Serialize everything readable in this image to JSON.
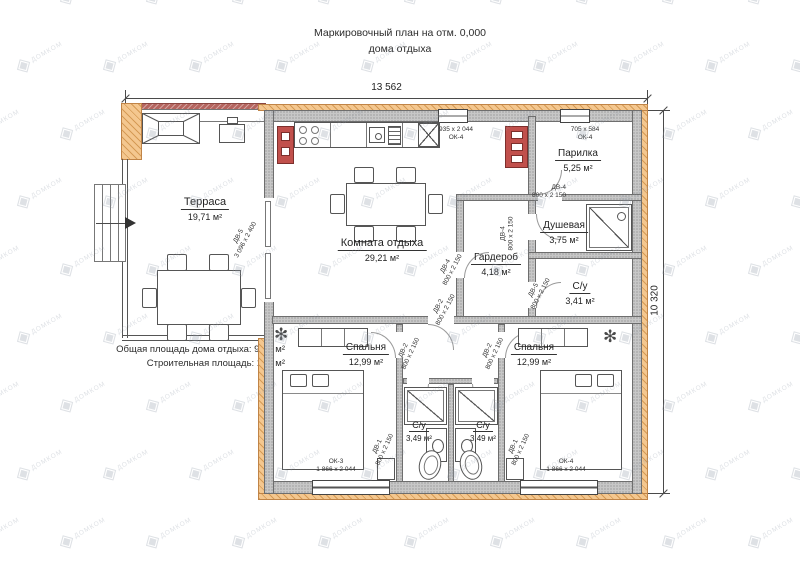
{
  "title": {
    "line1": "Маркировочный план на отм. 0,000",
    "line2": "дома отдыха"
  },
  "dimensions": {
    "top": "13 562",
    "right": "10 320"
  },
  "summary": {
    "line1": "Общая площадь дома отдыха: 98,5 м²",
    "line2": "Строительная площадь: 127 м²"
  },
  "watermark": {
    "brand": "ДОМКОМ",
    "glyph": "◈"
  },
  "rooms": {
    "terrace": {
      "name": "Терраса",
      "area": "19,71 м²"
    },
    "lounge": {
      "name": "Комната отдыха",
      "area": "29,21 м²"
    },
    "sauna": {
      "name": "Парилка",
      "area": "5,25 м²"
    },
    "shower": {
      "name": "Душевая",
      "area": "3,75 м²"
    },
    "wardrobe": {
      "name": "Гардероб",
      "area": "4,18 м²"
    },
    "wc_small": {
      "name": "С/у",
      "area": "3,41 м²"
    },
    "bedroom_left": {
      "name": "Спальня",
      "area": "12,99 м²"
    },
    "bedroom_right": {
      "name": "Спальня",
      "area": "12,99 м²"
    },
    "bath_left": {
      "name": "С/у",
      "area": "3,49 м²"
    },
    "bath_right": {
      "name": "С/у",
      "area": "3,49 м²"
    }
  },
  "windows": {
    "kitchen": {
      "mark": "ОК-4",
      "size": "935 x 2 044"
    },
    "sauna": {
      "mark": "ОК-4",
      "size": "705 x 584"
    },
    "bedroom_left": {
      "mark": "ОК-3",
      "size": "1 866 x 2 044"
    },
    "bedroom_right": {
      "mark": "ОК-4",
      "size": "1 866 x 2 044"
    }
  },
  "doors": {
    "terrace": {
      "mark": "ДВ-5",
      "size": "3 096 x 2 400"
    },
    "sauna": {
      "mark": "ДВ-4",
      "size": "800 x 2 150"
    },
    "shower": {
      "mark": "ДВ-4",
      "size": "800 x 2 150"
    },
    "wardrobe": {
      "mark": "ДВ-4",
      "size": "800 x 2 150"
    },
    "wc_small": {
      "mark": "ДВ-5",
      "size": "800 x 2 150"
    },
    "lounge_hall": {
      "mark": "ДВ-2",
      "size": "800 x 2 150"
    },
    "bedroom_left": {
      "mark": "ДВ-2",
      "size": "800 x 2 150"
    },
    "bedroom_right": {
      "mark": "ДВ-2",
      "size": "800 x 2 150"
    },
    "bath_left": {
      "mark": "ДВ-1",
      "size": "800 x 2 150"
    },
    "bath_right": {
      "mark": "ДВ-1",
      "size": "800 x 2 150"
    }
  },
  "colors": {
    "wall": "#c7c7c7",
    "cladding": "#f4c78f",
    "brick": "#c1504c",
    "roof_strip": "#b5655f",
    "line": "#4a4a4a"
  }
}
